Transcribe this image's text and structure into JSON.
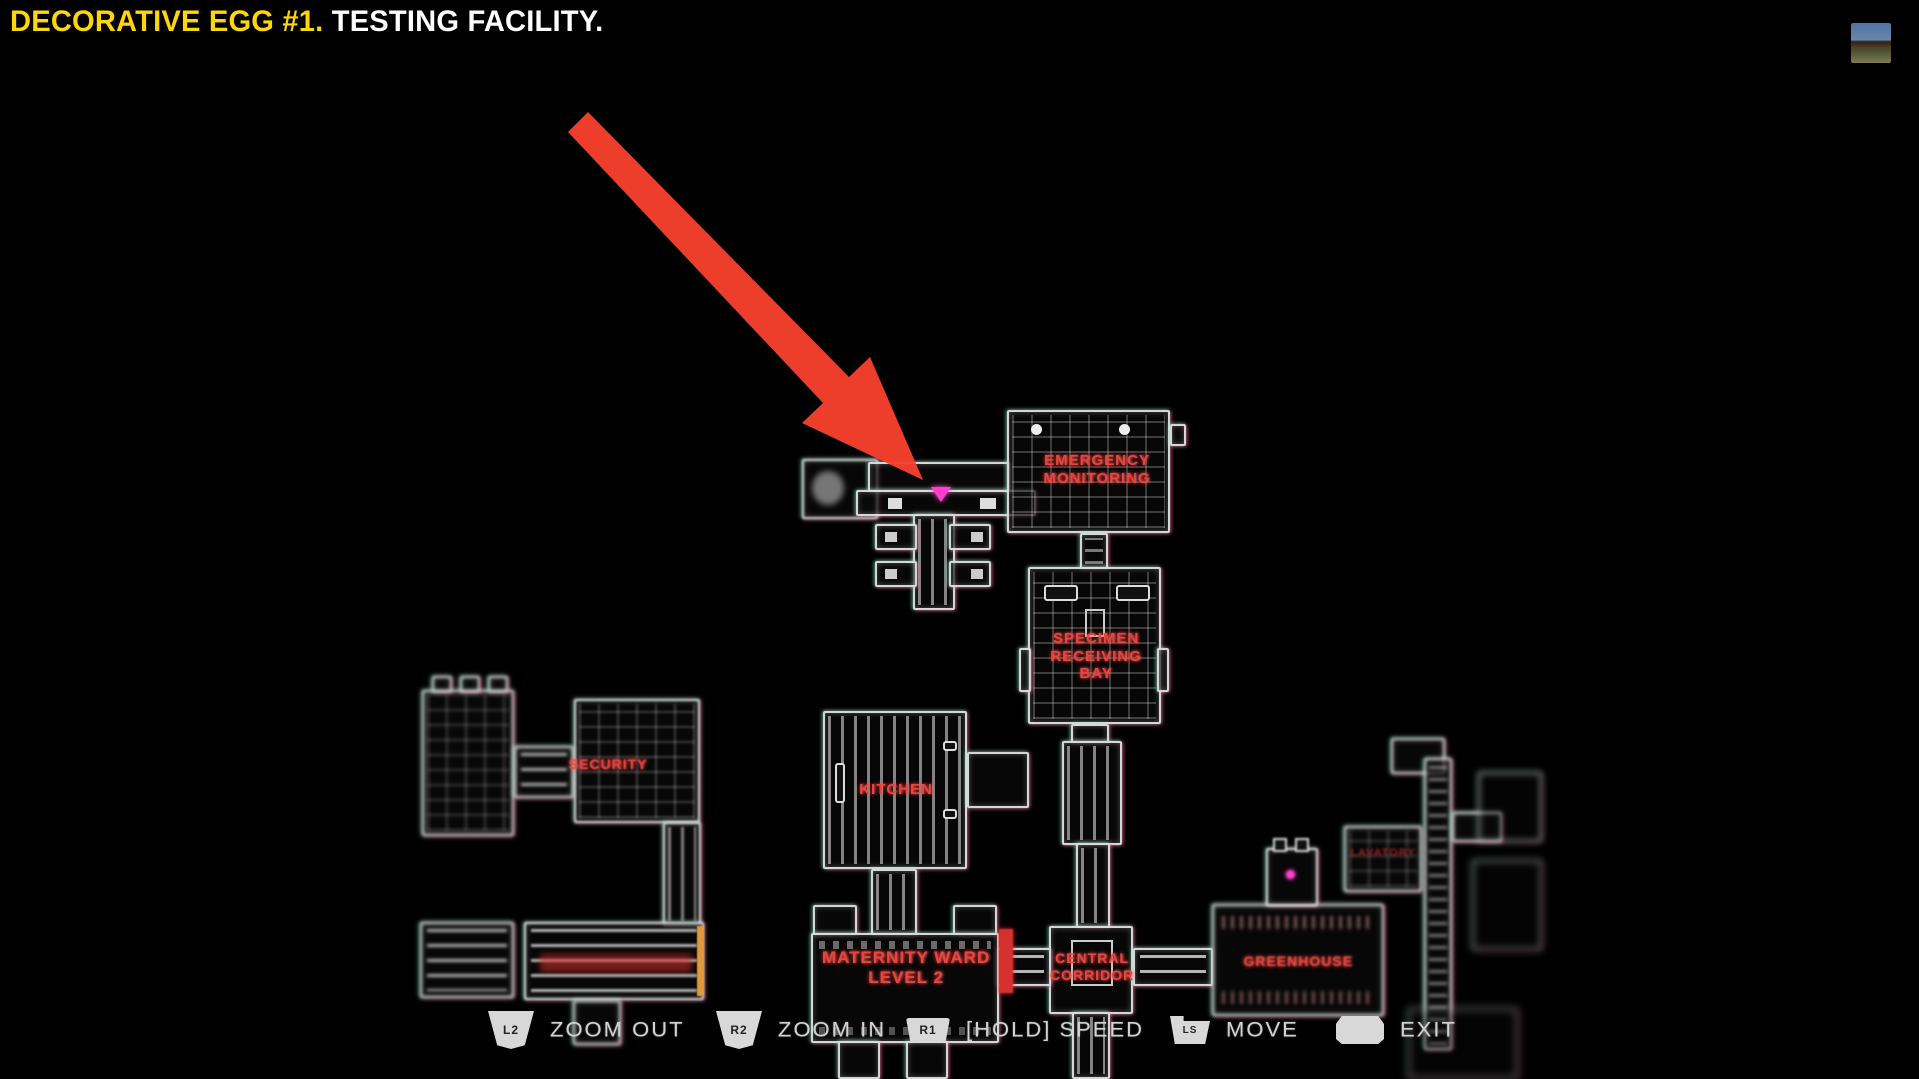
{
  "title": {
    "highlight": "DECORATIVE EGG #1.",
    "rest": "TESTING FACILITY."
  },
  "map": {
    "rooms": {
      "emergency_monitoring": {
        "lines": [
          "EMERGENCY",
          "MONITORING"
        ]
      },
      "specimen_receiving_bay": {
        "lines": [
          "SPECIMEN",
          "RECEIVING",
          "BAY"
        ]
      },
      "kitchen": {
        "label": "KITCHEN"
      },
      "security": {
        "label": "SECURITY"
      },
      "maternity_ward": {
        "lines": [
          "MATERNITY WARD",
          "LEVEL 2"
        ]
      },
      "central_corridor": {
        "lines": [
          "CENTRAL",
          "CORRIDOR"
        ]
      },
      "greenhouse": {
        "label": "GREENHOUSE"
      },
      "lavatory": {
        "label": "LAVATORY"
      }
    },
    "marker": {
      "meaning": "egg-location-marker",
      "color": "#ff40cc"
    },
    "annotation_arrow_color": "#f7402d",
    "label_color": "#e8453c"
  },
  "controls": {
    "hints": [
      {
        "button": "L2",
        "label": "ZOOM OUT"
      },
      {
        "button": "R2",
        "label": "ZOOM IN"
      },
      {
        "button": "R1",
        "label": "[HOLD] SPEED"
      },
      {
        "button": "LS",
        "label": "MOVE"
      },
      {
        "button": "",
        "label": "EXIT"
      }
    ]
  }
}
